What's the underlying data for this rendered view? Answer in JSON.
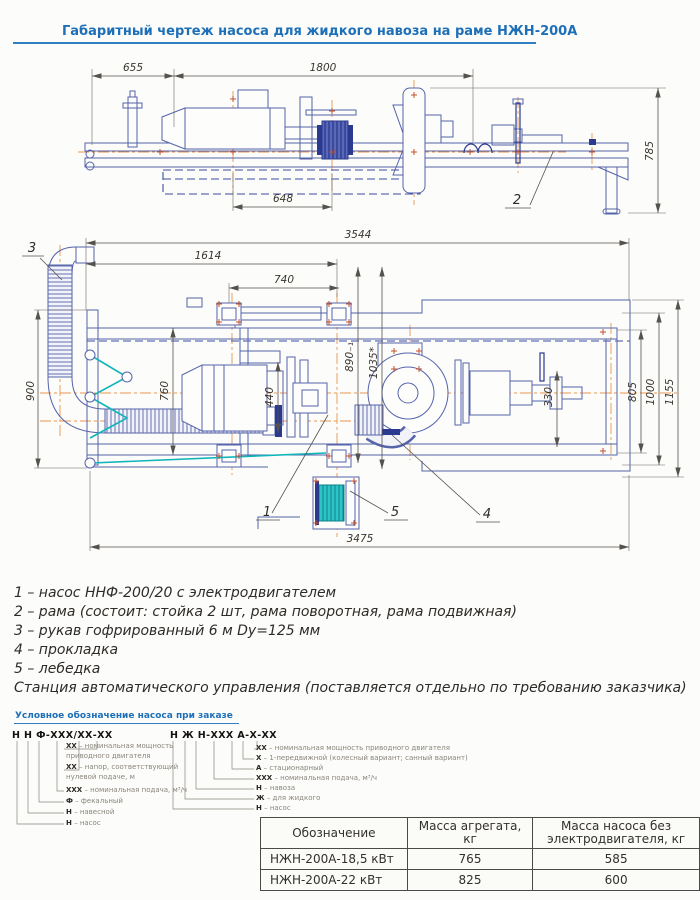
{
  "title": "Габаритный чертеж насоса для жидкого навоза на раме НЖН-200А",
  "side_view": {
    "dim_655": "655",
    "dim_1800": "1800",
    "dim_785": "785",
    "dim_648": "648",
    "label_frame": "2"
  },
  "plan_view": {
    "dim_3544": "3544",
    "dim_1614": "1614",
    "dim_740": "740",
    "dim_900": "900",
    "dim_760": "760",
    "dim_890": "890₋₁",
    "dim_1035": "1035*",
    "dim_440": "440",
    "dim_330": "330",
    "dim_805": "805",
    "dim_1000": "1000",
    "dim_1155": "1155",
    "dim_3475": "3475",
    "label_pump": "1",
    "label_hose": "3",
    "label_gasket": "4",
    "label_winch": "5"
  },
  "legend": {
    "items": [
      "1 – насос ННФ-200/20 с электродвигателем",
      "2 – рама (состоит: стойка 2 шт, рама поворотная, рама подвижная)",
      "3 – рукав гофрированный 6 м Dу=125 мм",
      "4 – прокладка",
      "5 – лебедка",
      "Станция автоматического управления (поставляется отдельно по требованию заказчика)"
    ]
  },
  "ordering": {
    "heading": "Условное обозначение насоса при заказе",
    "left": {
      "code": "Н Н Ф-ХХХ/ХХ-ХХ",
      "items": [
        {
          "code": "ХХ",
          "desc": "– номинальная мощность приводного двигателя"
        },
        {
          "code": "ХХ",
          "desc": "– напор, соответствующий нулевой подаче, м"
        },
        {
          "code": "ХХХ",
          "desc": "– номинальная подача, м³/ч"
        },
        {
          "code": "Ф",
          "desc": "– фекальный"
        },
        {
          "code": "Н",
          "desc": "– навесной"
        },
        {
          "code": "Н",
          "desc": "– насос"
        }
      ]
    },
    "right": {
      "code": "Н Ж Н-ХХХ А-Х-ХХ",
      "items": [
        {
          "code": "ХХ",
          "desc": "– номинальная мощность приводного двигателя"
        },
        {
          "code": "Х",
          "desc": "– 1-передвижной (колесный вариант; санный вариант)"
        },
        {
          "code": "А",
          "desc": "– стационарный"
        },
        {
          "code": "ХХХ",
          "desc": "– номинальная подача, м³/ч"
        },
        {
          "code": "Н",
          "desc": "– навоза"
        },
        {
          "code": "Ж",
          "desc": "– для жидкого"
        },
        {
          "code": "Н",
          "desc": "– насос"
        }
      ]
    }
  },
  "table": {
    "headers": [
      "Обозначение",
      "Масса агрегата, кг",
      "Масса насоса без электродвигателя, кг"
    ],
    "rows": [
      [
        "НЖН-200А-18,5 кВт",
        "765",
        "585"
      ],
      [
        "НЖН-200А-22 кВт",
        "825",
        "600"
      ]
    ]
  },
  "colors": {
    "line": "#5563aa",
    "line_dark": "#2b3a8f",
    "centerline": "#e8964e",
    "accent_cyan": "#10b5ba",
    "bolt_red": "#c2512d",
    "title_blue": "#1d6fb8",
    "dim_text": "#3a352f"
  }
}
